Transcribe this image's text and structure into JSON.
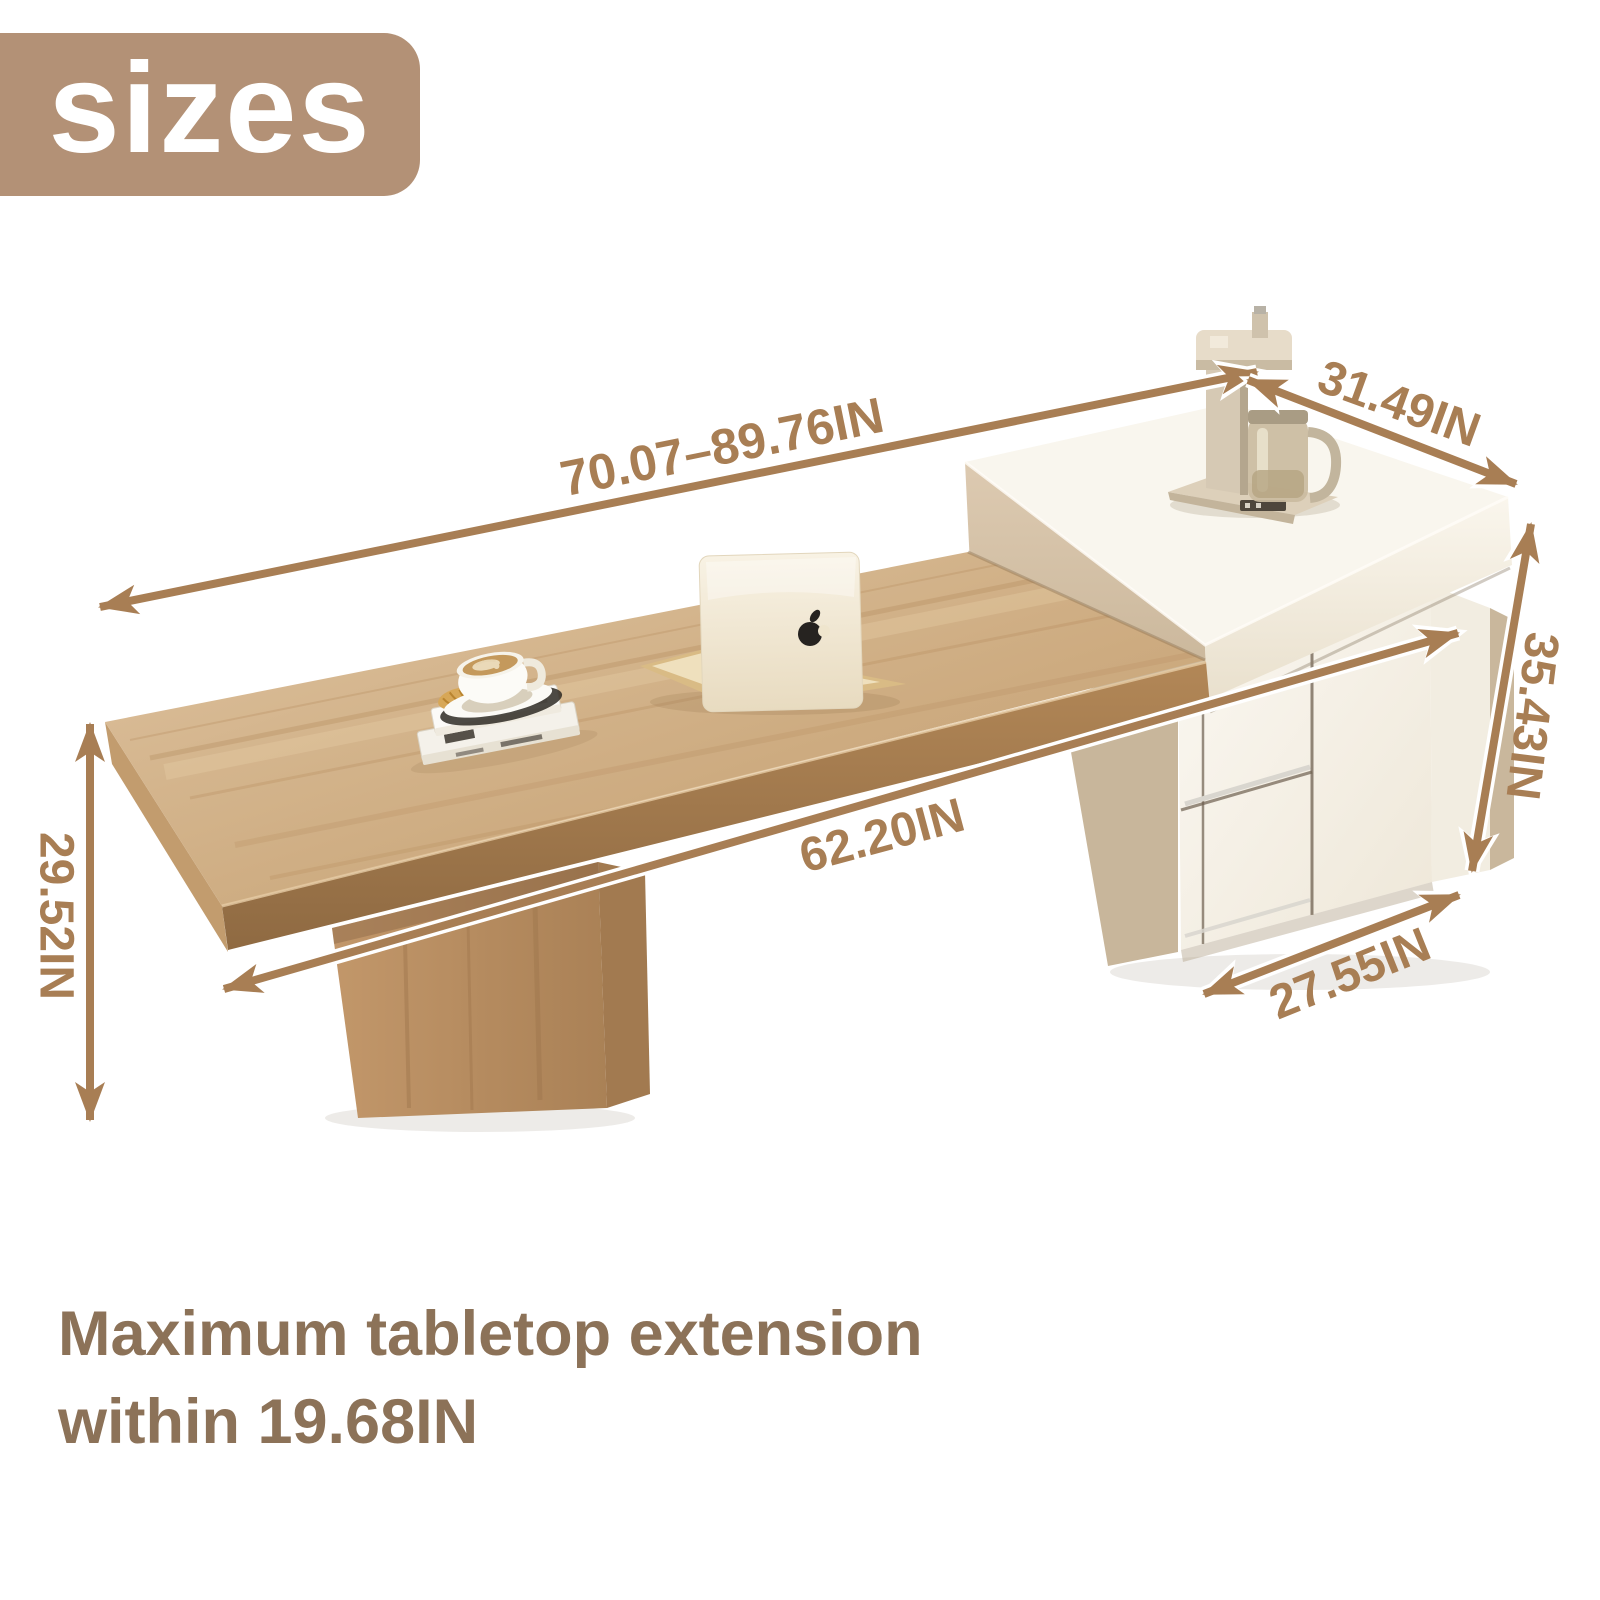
{
  "badge": {
    "label": "sizes"
  },
  "dimensions": {
    "overall_length": "70.07–89.76IN",
    "top_depth": "31.49IN",
    "right_height": "35.43IN",
    "tabletop_length": "62.20IN",
    "left_height": "29.52IN",
    "cabinet_depth": "27.55IN"
  },
  "caption": {
    "line1": "Maximum tabletop extension",
    "line2": "within 19.68IN"
  },
  "colors": {
    "accent_arrow": "#a87e54",
    "badge_background": "#b39176",
    "caption_text": "#8c7258",
    "wood_light": "#dcbf9d",
    "wood_dark": "#a97e52",
    "cabinet_white": "#f7f3ea",
    "cabinet_beige": "#d5c2a8"
  }
}
